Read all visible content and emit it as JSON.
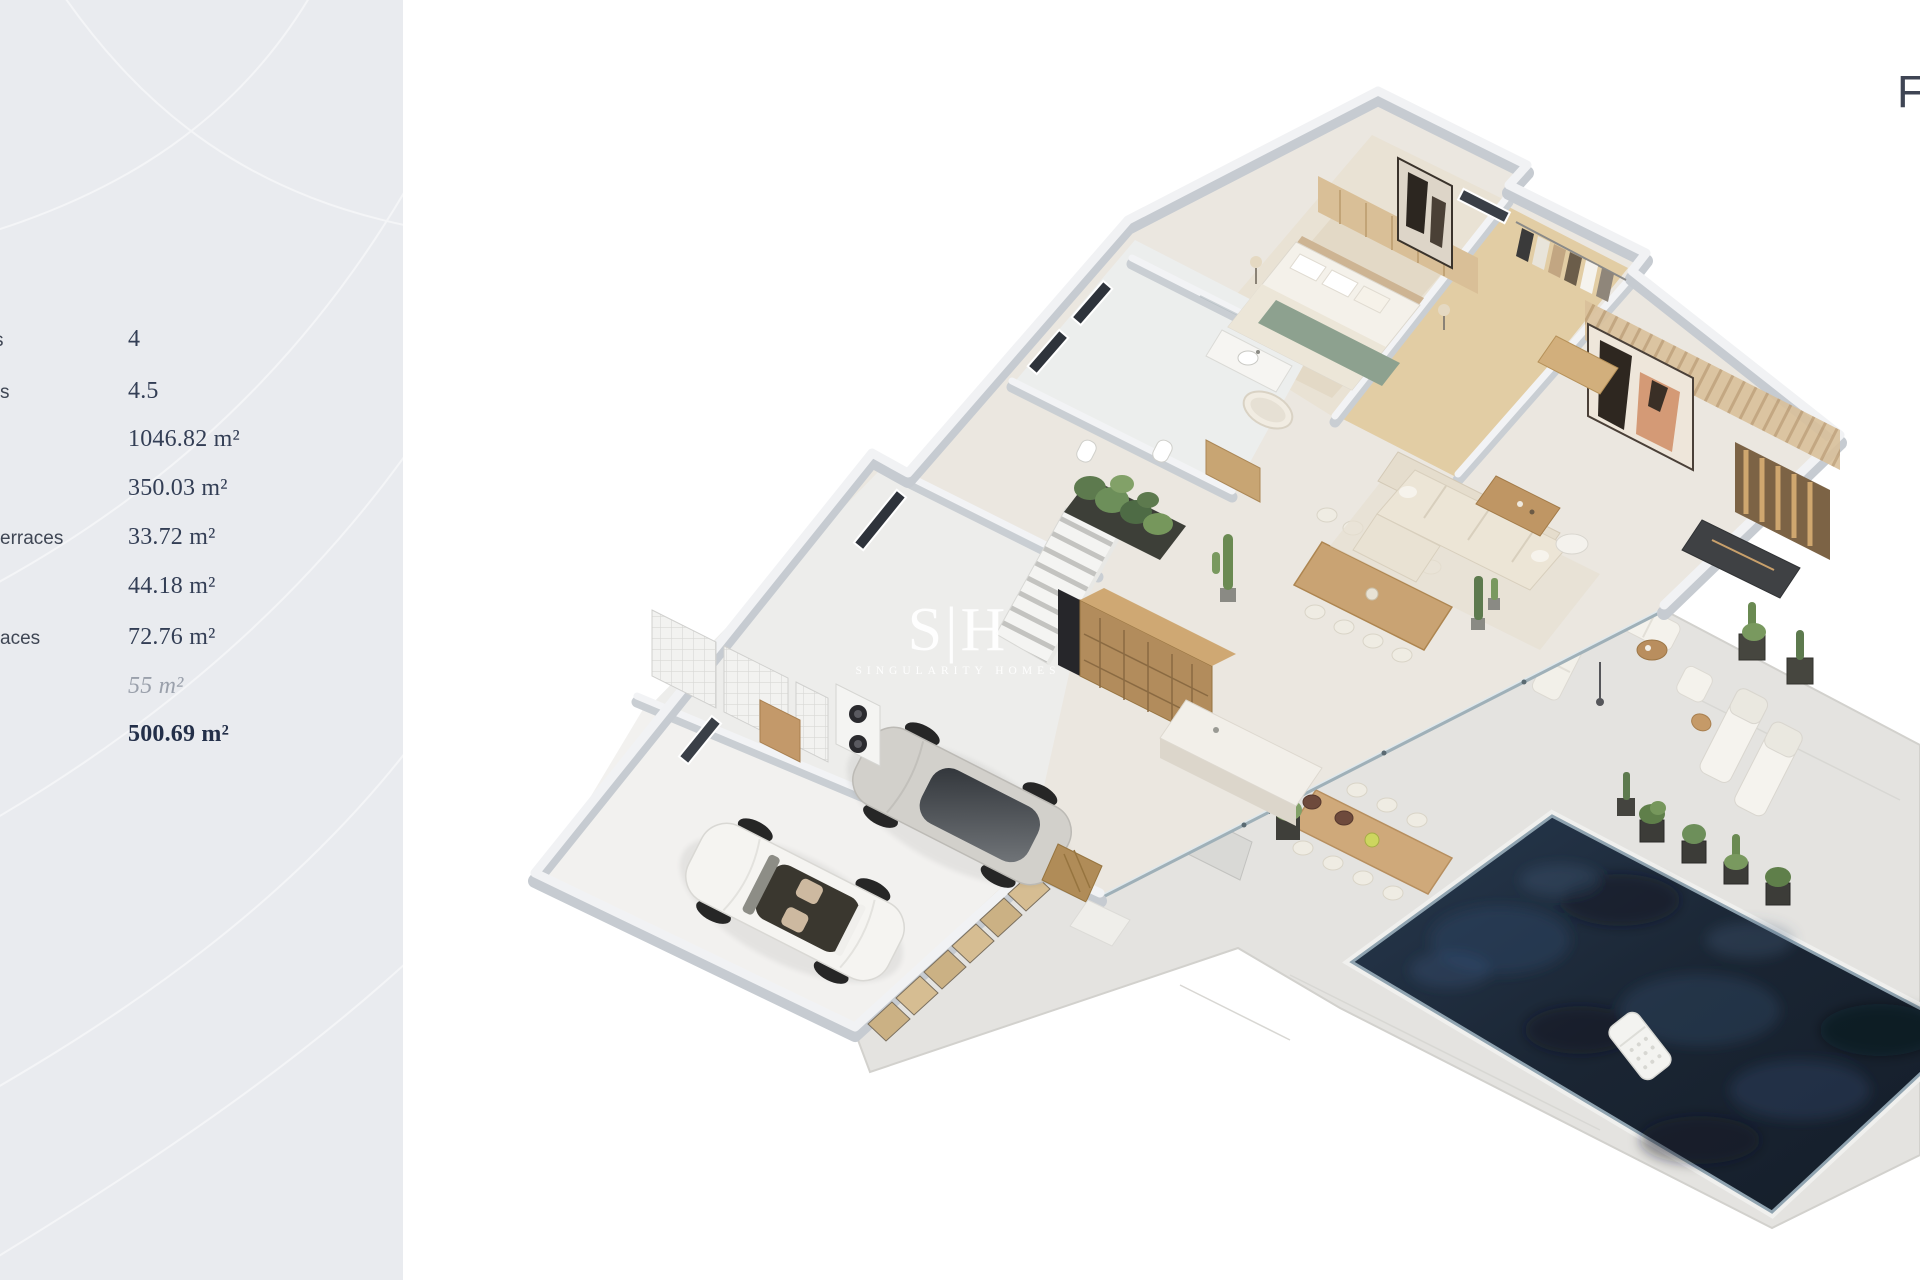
{
  "sidebar": {
    "panel_color": "#e9ebef",
    "rows": [
      {
        "label_fragment": "s",
        "value": "4"
      },
      {
        "label_fragment": "s",
        "value": "4.5"
      },
      {
        "label_fragment": "",
        "value": "1046.82 m²"
      },
      {
        "label_fragment": "",
        "value": "350.03 m²"
      },
      {
        "label_fragment": "erraces",
        "value": "33.72 m²"
      },
      {
        "label_fragment": "",
        "value": "44.18 m²"
      },
      {
        "label_fragment": "aces",
        "value": "72.76 m²"
      },
      {
        "label_fragment": "",
        "value": "55 m²"
      },
      {
        "label_fragment": "",
        "value": "500.69 m²"
      }
    ]
  },
  "watermark": {
    "initials": "S|H",
    "wordmark": "SINGULARITY HOMES"
  },
  "corner": {
    "floor_label": "F"
  },
  "scene": {
    "colors": {
      "pool_water": "#1d2a3a",
      "wall_gray": "#c6cbd1",
      "wood": "#c9a878",
      "floor": "#ebe7e0",
      "deck": "#e4e3e0",
      "text_navy": "#333e55",
      "accent_green": "#6f8f57"
    }
  }
}
